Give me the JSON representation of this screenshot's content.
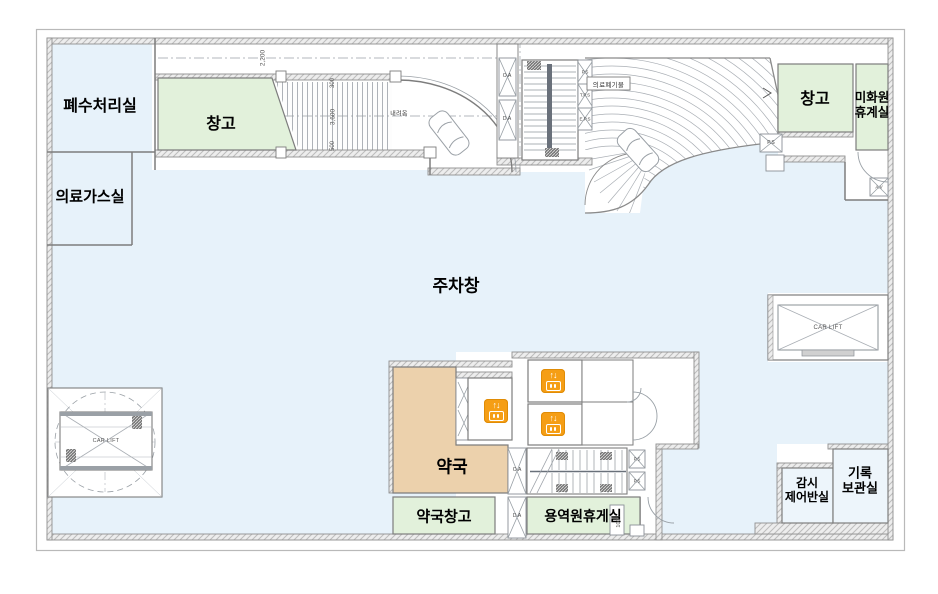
{
  "colors": {
    "parking_fill": "#e7f2fa",
    "room_green": "#e2f1db",
    "room_tan": "#ecd1ac",
    "elevator_orange": "#f59e15",
    "wall_gray": "#8f8f8f"
  },
  "rooms": {
    "waste_water": "폐수처리실",
    "storage_left": "창고",
    "medical_gas": "의료가스실",
    "parking": "주차창",
    "pharmacy": "약국",
    "pharmacy_storage": "약국창고",
    "service_lounge": "용역원휴게실",
    "storage_right": "창고",
    "cleaner_line1": "미화원",
    "cleaner_line2": "휴계실",
    "control_line1": "감시",
    "control_line2": "제어반실",
    "records_line1": "기록",
    "records_line2": "보관실"
  },
  "labels": {
    "car_lift": "CAR LIFT",
    "medical_waste": "의료폐기물",
    "ramp_down": "내려옴",
    "elevator_arrows": "↑↓"
  },
  "shafts": {
    "oa": "O.A",
    "da": "D.A",
    "ps": "P.S",
    "tps": "T.P.S",
    "eps": "E.P.S",
    "av": "A.V"
  },
  "dimensions": {
    "d2200": "2,200",
    "d300": "300",
    "d3600": "3,600",
    "d500": "500",
    "d100": "100"
  }
}
